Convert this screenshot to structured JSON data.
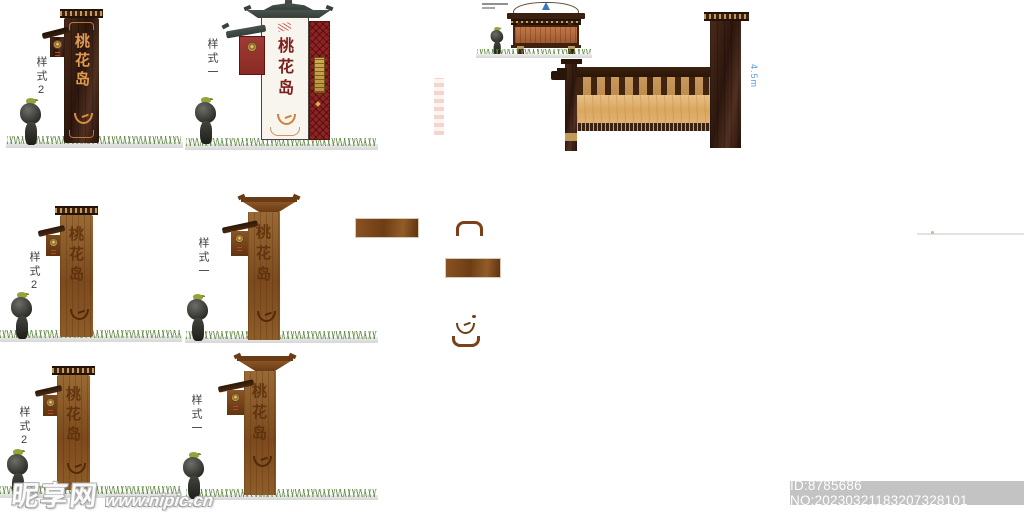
{
  "signs": {
    "main_text": "桃花岛",
    "style2_label": "样式2",
    "style1_label": "样式一"
  },
  "section_view": {
    "dimension_label": "4.5m"
  },
  "watermark": {
    "site_name": "昵享网",
    "site_url": "www.nipic.cn"
  },
  "id_bar": {
    "text": "ID:8785686 NO:20230321183207328101"
  },
  "colors": {
    "dark_wood": "#3a2113",
    "medium_wood": "#8a5526",
    "light_panel": "#ddae68",
    "red_panel": "#8e2323",
    "accent_orange": "#e09a50",
    "sign_red_text": "#7c1f1c",
    "dimension_blue": "#5b9bd5",
    "grass_green": "#6f9c49"
  }
}
